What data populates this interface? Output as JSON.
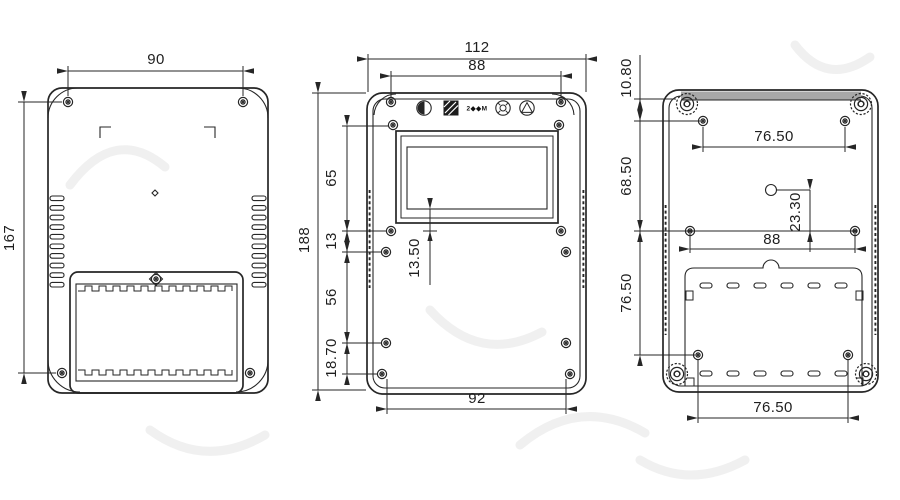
{
  "dims": {
    "back_outer": {
      "width": "90",
      "height": "167"
    },
    "front": {
      "width": "112",
      "screw_span": "88",
      "height": "188",
      "seg_a": "65",
      "seg_b": "13",
      "seg_c": "56",
      "seg_d": "18.70",
      "display_offset": "13.50",
      "bottom_span": "92"
    },
    "inner_back": {
      "top_offset": "10.80",
      "upper_span": "68.50",
      "lower_span": "76.50",
      "top_holes": "76.50",
      "hanger_offset": "23.30",
      "mid_holes": "88",
      "bottom_holes": "76.50"
    }
  },
  "marks": {
    "cert_text": "2◆◆M"
  },
  "colors": {
    "line": "#262626",
    "top_band": "#a8a8a8",
    "background": "#ffffff"
  }
}
